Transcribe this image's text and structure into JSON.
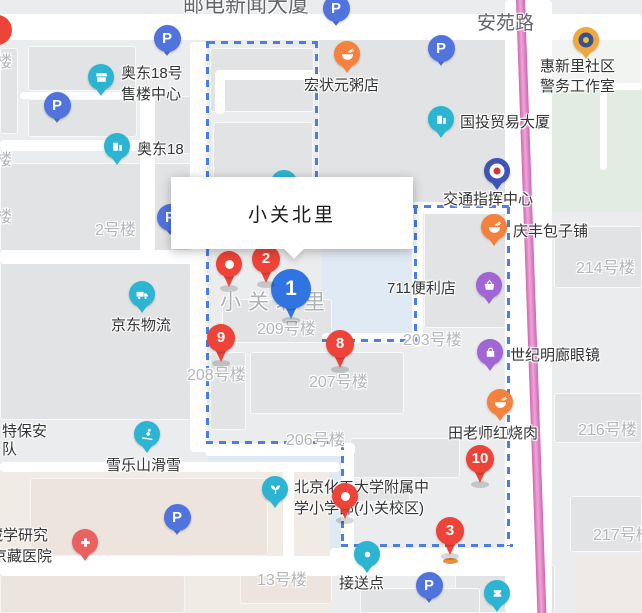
{
  "tooltip": {
    "title": "小关北里"
  },
  "colors": {
    "marker_red": "#ee4338",
    "marker_blue": "#2f74e0",
    "parking_blue": "#5173de",
    "teal": "#2cb5d2",
    "orange": "#f6813c",
    "purple": "#a265d5",
    "hospital_red": "#e96161",
    "badge_gold": "#eea83e",
    "badge_navy": "#3a4e91",
    "badge_blue": "#3d55b7",
    "boundary_blue": "#4b7ee4",
    "highway_pink": "#cf66b2",
    "area_fill_blue": "#dfeaf4",
    "park_green": "#e2ece3"
  },
  "street_labels": [
    {
      "text": "安苑路",
      "x": 477,
      "y": 8,
      "size": 19
    },
    {
      "text": "邮电新闻大厦",
      "x": 183,
      "y": -11,
      "size": 21
    }
  ],
  "area_label": {
    "text": "小关北里",
    "x": 220,
    "y": 286
  },
  "building_labels": [
    {
      "text": "2号楼",
      "x": 95,
      "y": 216
    },
    {
      "text": "209号楼",
      "x": 257,
      "y": 315
    },
    {
      "text": "208号楼",
      "x": 187,
      "y": 361
    },
    {
      "text": "207号楼",
      "x": 309,
      "y": 368
    },
    {
      "text": "206号楼",
      "x": 286,
      "y": 426
    },
    {
      "text": "203号楼",
      "x": 403,
      "y": 326
    },
    {
      "text": "214号楼",
      "x": 576,
      "y": 254
    },
    {
      "text": "216号楼",
      "x": 578,
      "y": 416
    },
    {
      "text": "217号楼",
      "x": 593,
      "y": 521
    },
    {
      "text": "13号楼",
      "x": 257,
      "y": 566
    },
    {
      "text": "楼",
      "x": -4,
      "y": 48
    },
    {
      "text": "楼",
      "x": -4,
      "y": 146
    },
    {
      "text": "楼",
      "x": -4,
      "y": 203
    }
  ],
  "pois": [
    {
      "name": "aodong-18-sales-center",
      "icon": {
        "type": "shop",
        "x": 101,
        "y": 77
      },
      "lines": [
        {
          "t": "奥东18号",
          "x": 121,
          "y": 62
        },
        {
          "t": "售楼中心",
          "x": 121,
          "y": 83
        }
      ]
    },
    {
      "name": "aodong-18",
      "icon": {
        "type": "building",
        "x": 117,
        "y": 146
      },
      "lines": [
        {
          "t": "奥东18",
          "x": 137,
          "y": 138
        }
      ]
    },
    {
      "name": "hongzhuangyuan-porridge",
      "icon": {
        "type": "bowl",
        "x": 347,
        "y": 54
      },
      "lines": [
        {
          "t": "宏状元粥店",
          "x": 304,
          "y": 74
        }
      ]
    },
    {
      "name": "guotou-trade-tower",
      "icon": {
        "type": "building",
        "x": 441,
        "y": 119
      },
      "lines": [
        {
          "t": "国投贸易大厦",
          "x": 460,
          "y": 111
        }
      ]
    },
    {
      "name": "huixinli-police-office",
      "icon": {
        "type": "badge-gold",
        "x": 586,
        "y": 40
      },
      "lines": [
        {
          "t": "惠新里社区",
          "x": 540,
          "y": 55
        },
        {
          "t": "警务工作室",
          "x": 540,
          "y": 75
        }
      ]
    },
    {
      "name": "traffic-command-center",
      "icon": {
        "type": "badge-blue",
        "x": 497,
        "y": 171
      },
      "lines": [
        {
          "t": "交通指挥中心",
          "x": 443,
          "y": 188
        }
      ]
    },
    {
      "name": "qingfeng-baozi",
      "icon": {
        "type": "bowl",
        "x": 494,
        "y": 227
      },
      "lines": [
        {
          "t": "庆丰包子铺",
          "x": 513,
          "y": 220
        }
      ]
    },
    {
      "name": "711-store",
      "icon": {
        "type": "basket",
        "x": 489,
        "y": 285
      },
      "lines": [
        {
          "t": "711便利店",
          "x": 387,
          "y": 277
        }
      ]
    },
    {
      "name": "shiji-minglang-glasses",
      "icon": {
        "type": "bag",
        "x": 490,
        "y": 352
      },
      "lines": [
        {
          "t": "世纪明廊眼镜",
          "x": 510,
          "y": 344
        }
      ]
    },
    {
      "name": "tianlaoshi-braised-pork",
      "icon": {
        "type": "bowl",
        "x": 500,
        "y": 402
      },
      "lines": [
        {
          "t": "田老师红烧肉",
          "x": 448,
          "y": 422
        }
      ]
    },
    {
      "name": "jd-logistics",
      "icon": {
        "type": "truck",
        "x": 142,
        "y": 294
      },
      "lines": [
        {
          "t": "京东物流",
          "x": 111,
          "y": 314
        }
      ]
    },
    {
      "name": "xueleshan-ski",
      "icon": {
        "type": "ski",
        "x": 147,
        "y": 434
      },
      "lines": [
        {
          "t": "雪乐山滑雪",
          "x": 106,
          "y": 454
        }
      ]
    },
    {
      "name": "primary-school-xiaoguan",
      "icon": {
        "type": "sprout",
        "x": 275,
        "y": 489
      },
      "lines": [
        {
          "t": "北京化工大学附属中",
          "x": 294,
          "y": 476
        },
        {
          "t": "学小学部(小关校区)",
          "x": 294,
          "y": 497
        }
      ]
    },
    {
      "name": "pickup-point",
      "icon": {
        "type": "dot",
        "x": 367,
        "y": 554
      },
      "lines": [
        {
          "t": "接送点",
          "x": 339,
          "y": 572
        }
      ]
    },
    {
      "name": "jingzang-hospital",
      "icon": {
        "type": "cross",
        "x": 85,
        "y": 542
      },
      "lines": [
        {
          "t": "藏学研究",
          "x": -12,
          "y": 524
        },
        {
          "t": "京藏医院",
          "x": -8,
          "y": 545
        }
      ]
    },
    {
      "name": "security-unit",
      "icon": null,
      "lines": [
        {
          "t": "特保安",
          "x": 2,
          "y": 420
        },
        {
          "t": "队",
          "x": 2,
          "y": 438
        }
      ]
    },
    {
      "name": "poi-theater",
      "icon": {
        "type": "theater",
        "x": 497,
        "y": 593
      },
      "lines": []
    },
    {
      "name": "poi-hidden-behind-tooltip",
      "icon": {
        "type": "dot",
        "x": 284,
        "y": 183
      },
      "lines": []
    }
  ],
  "numbered_markers": [
    {
      "label": "1",
      "color": "blue",
      "x": 291,
      "y": 289
    },
    {
      "label": "2",
      "color": "red",
      "x": 266,
      "y": 259
    },
    {
      "label": "3",
      "color": "red",
      "x": 450,
      "y": 531
    },
    {
      "label": "8",
      "color": "red",
      "x": 340,
      "y": 344
    },
    {
      "label": "9",
      "color": "red",
      "x": 221,
      "y": 338
    },
    {
      "label": "10",
      "color": "red",
      "x": 480,
      "y": 459
    }
  ],
  "plain_pins": [
    {
      "x": 229,
      "y": 264
    },
    {
      "x": 345,
      "y": 496
    }
  ],
  "edge_pin": {
    "x": -3,
    "y": 30
  },
  "parking_markers": {
    "letter": "P",
    "positions": [
      {
        "x": 167,
        "y": 38
      },
      {
        "x": 57,
        "y": 105
      },
      {
        "x": 336,
        "y": 8
      },
      {
        "x": 441,
        "y": 48
      },
      {
        "x": 170,
        "y": 217
      },
      {
        "x": 177,
        "y": 517
      },
      {
        "x": 429,
        "y": 585
      }
    ]
  }
}
